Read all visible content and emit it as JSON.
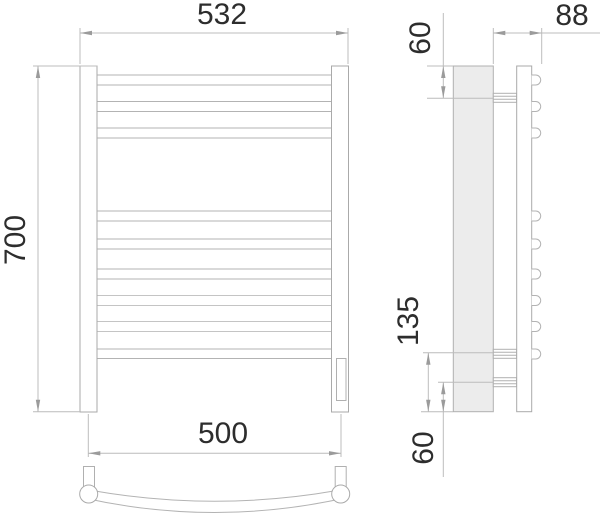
{
  "dimensions": {
    "front_width_top": "532",
    "front_height": "700",
    "rail_span_bottom": "500",
    "side_top_to_bracket": "60",
    "side_depth": "88",
    "side_bracket_to_bottom": "135",
    "side_lower_bracket_to_bottom": "60"
  },
  "counts": {
    "front_rails": 9,
    "side_rail_ends": 9,
    "side_wall_brackets": 3
  },
  "colors": {
    "background": "#ffffff",
    "part_line": "#aaaaaa",
    "rail_line": "#b3b3b3",
    "dim_line": "#bcbcbc",
    "arrow": "#9b9b9b",
    "text": "#2d2d2d",
    "wall_panel_fill": "#ececec"
  }
}
